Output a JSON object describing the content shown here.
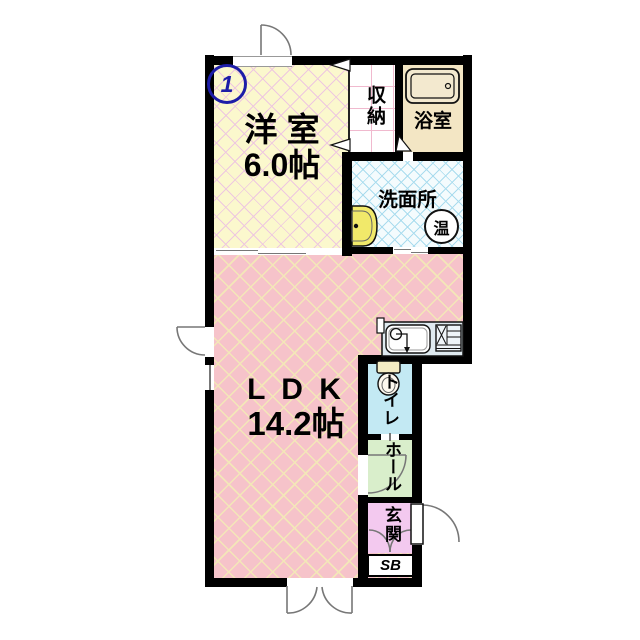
{
  "floorplan": {
    "unit_number": "1",
    "rooms": {
      "western_room": {
        "name": "洋 室",
        "size": "6.0帖"
      },
      "ldk": {
        "name": "L D K",
        "size": "14.2帖"
      },
      "closet": {
        "name": "収納"
      },
      "bathroom": {
        "name": "浴室"
      },
      "washroom": {
        "name": "洗面所"
      },
      "toilet": {
        "name": "トイレ"
      },
      "hall": {
        "name": "ホール"
      },
      "entrance": {
        "name": "玄関"
      },
      "shoe_box": {
        "name": "SB"
      }
    },
    "labels": {
      "water_heater": "温"
    },
    "colors": {
      "western_room": "#fbf8cd",
      "ldk": "#f6c3ca",
      "closet": "#ffffff",
      "bathroom": "#f3e6c4",
      "washroom": "#f4fbfd",
      "toilet": "#c3e9f3",
      "hall": "#d9eecb",
      "entrance": "#f3c9ef",
      "shoe_box": "#ffffff",
      "wall": "#000000",
      "badge_blue": "#1d1da8"
    }
  }
}
